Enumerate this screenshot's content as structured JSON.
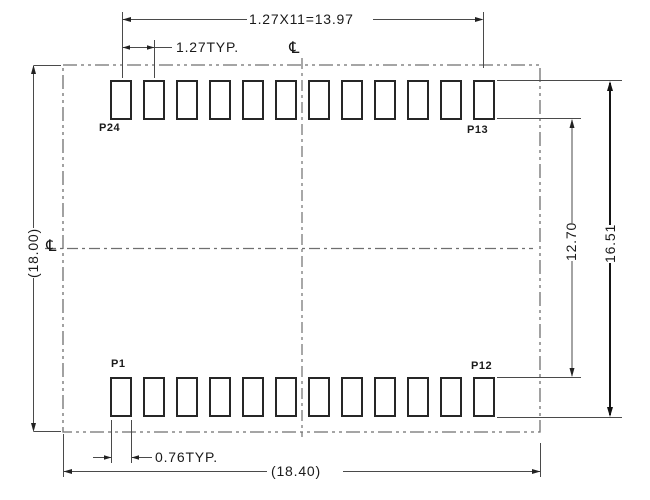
{
  "diagram": {
    "type": "pcb-land-pattern-drawing",
    "pads": {
      "rows": 2,
      "per_row": 12
    },
    "pins": {
      "top_left": "P24",
      "top_right": "P13",
      "bottom_left": "P1",
      "bottom_right": "P12"
    },
    "dims": {
      "top_span": "1.27X11=13.97",
      "pitch": "1.27TYP.",
      "height": "(18.00)",
      "row_inner_gap": "12.70",
      "row_outer_span": "16.51",
      "pad_width": "0.76TYP.",
      "width": "(18.40)"
    },
    "symbols": {
      "centerline_top": "℄",
      "centerline_left": "℄"
    },
    "colors": {
      "background": "#ffffff",
      "dimension_line": "#4a4a4a",
      "outline_line": "#6f6f6f",
      "pad_border": "#262626",
      "emphasis_line": "#151515",
      "text": "#1a1a1a"
    }
  }
}
